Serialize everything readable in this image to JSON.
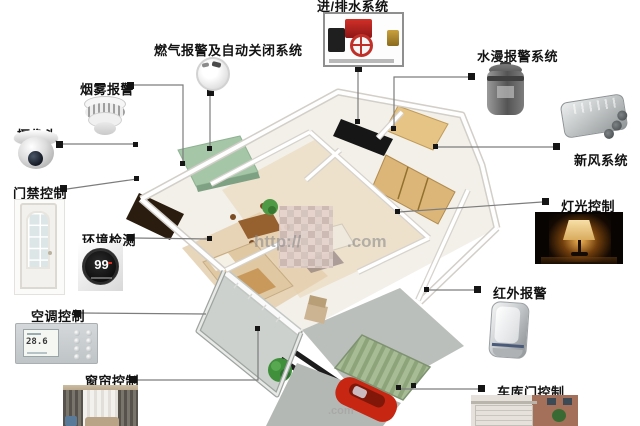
{
  "labels": {
    "gas_alarm": "燃气报警及自动关闭系统",
    "water_supply": "进/排水系统",
    "flood_alarm": "水漫报警系统",
    "smoke_alarm": "烟雾报警",
    "camera": "摄像头",
    "fresh_air": "新风系统",
    "door_access": "门禁控制",
    "light_control": "灯光控制",
    "env_monitor": "环境检测",
    "infrared_alarm": "红外报警",
    "ac_control": "空调控制",
    "curtain_control": "窗帘控制",
    "garage_door": "车库门控制"
  },
  "readings": {
    "thermostat": "99",
    "ac_panel": "28.6"
  },
  "watermark": {
    "prefix": "http://",
    "suffix": ".com"
  },
  "colors": {
    "label_text": "#121212",
    "connector": "#7d7d7d",
    "marker": "#151515",
    "kitchen_counter": "#a5c7a8",
    "garage_roof": "#a7bb94",
    "car": "#c62612"
  }
}
